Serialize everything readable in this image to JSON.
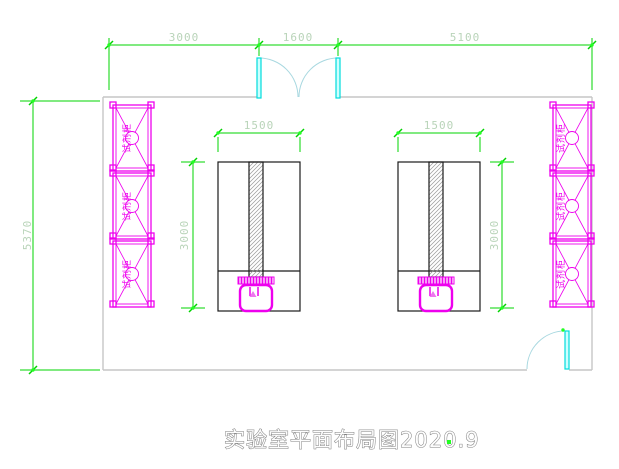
{
  "drawing": {
    "title": "实验室平面布局图2020.9",
    "dimensions": {
      "top_segments": [
        "3000",
        "1600",
        "5100"
      ],
      "left_overall": "5370",
      "bench1_width": "1500",
      "bench2_width": "1500",
      "bench1_height": "3000",
      "bench2_height": "3000"
    },
    "cabinet_label": "试剂柜",
    "colors": {
      "wall": "#c6c6c6",
      "bench": "#1a1a1a",
      "furniture": "#ee00ee",
      "door_panel": "#00dcdc",
      "door_panel_fill": "#ccffff",
      "door_arc": "#a8d8e0",
      "dimension_line": "#00d400",
      "dimension_text": "#b9d4b9",
      "grip": "#22ff22",
      "title_outline": "#7d7d7d"
    }
  }
}
